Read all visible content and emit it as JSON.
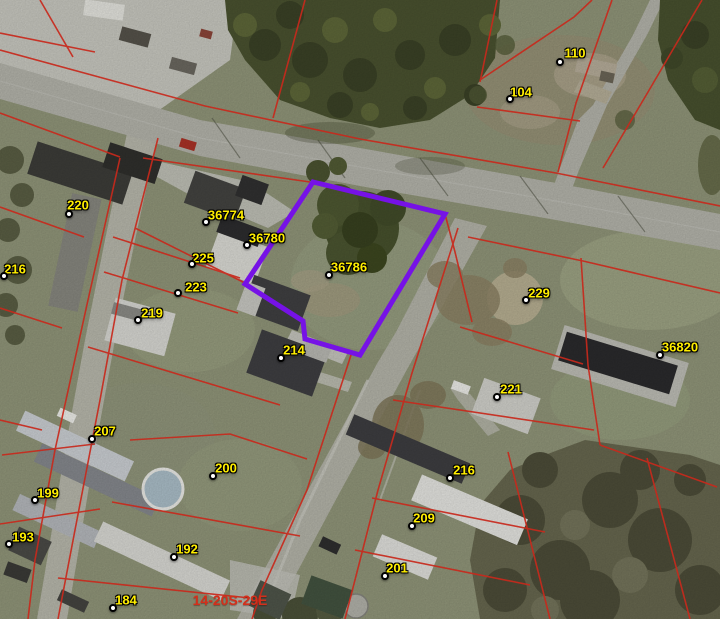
{
  "map": {
    "type": "parcel-aerial-view",
    "selected_parcel_id": "36786",
    "section_label": "14-20S-29E",
    "section_label_pos": {
      "x": 230,
      "y": 600
    },
    "colors": {
      "label-yellow": "#ffee00",
      "cadastral-red": "#c8291c",
      "selected-purple": "#7612e6",
      "section-red": "#d32f1b"
    },
    "labels": [
      {
        "text": "110",
        "tx": 575,
        "ty": 53,
        "dx": 560,
        "dy": 62
      },
      {
        "text": "104",
        "tx": 521,
        "ty": 92,
        "dx": 510,
        "dy": 99
      },
      {
        "text": "220",
        "tx": 78,
        "ty": 205,
        "dx": 69,
        "dy": 214
      },
      {
        "text": "36774",
        "tx": 226,
        "ty": 215,
        "dx": 206,
        "dy": 222
      },
      {
        "text": "36780",
        "tx": 267,
        "ty": 238,
        "dx": 247,
        "dy": 245
      },
      {
        "text": "225",
        "tx": 203,
        "ty": 258,
        "dx": 192,
        "dy": 264
      },
      {
        "text": "216",
        "tx": 15,
        "ty": 269,
        "dx": 4,
        "dy": 276
      },
      {
        "text": "223",
        "tx": 196,
        "ty": 287,
        "dx": 178,
        "dy": 293
      },
      {
        "text": "219",
        "tx": 152,
        "ty": 313,
        "dx": 138,
        "dy": 320
      },
      {
        "text": "36786",
        "tx": 349,
        "ty": 267,
        "dx": 329,
        "dy": 275
      },
      {
        "text": "229",
        "tx": 539,
        "ty": 293,
        "dx": 526,
        "dy": 300
      },
      {
        "text": "36820",
        "tx": 680,
        "ty": 347,
        "dx": 660,
        "dy": 355
      },
      {
        "text": "214",
        "tx": 294,
        "ty": 350,
        "dx": 281,
        "dy": 358
      },
      {
        "text": "221",
        "tx": 511,
        "ty": 389,
        "dx": 497,
        "dy": 397
      },
      {
        "text": "207",
        "tx": 105,
        "ty": 431,
        "dx": 92,
        "dy": 439
      },
      {
        "text": "200",
        "tx": 226,
        "ty": 468,
        "dx": 213,
        "dy": 476
      },
      {
        "text": "199",
        "tx": 48,
        "ty": 493,
        "dx": 35,
        "dy": 500
      },
      {
        "text": "216",
        "tx": 464,
        "ty": 470,
        "dx": 450,
        "dy": 478
      },
      {
        "text": "193",
        "tx": 23,
        "ty": 537,
        "dx": 9,
        "dy": 544
      },
      {
        "text": "192",
        "tx": 187,
        "ty": 549,
        "dx": 174,
        "dy": 557
      },
      {
        "text": "209",
        "tx": 424,
        "ty": 518,
        "dx": 412,
        "dy": 526
      },
      {
        "text": "201",
        "tx": 397,
        "ty": 568,
        "dx": 385,
        "dy": 576
      },
      {
        "text": "184",
        "tx": 126,
        "ty": 600,
        "dx": 113,
        "dy": 608
      }
    ]
  }
}
